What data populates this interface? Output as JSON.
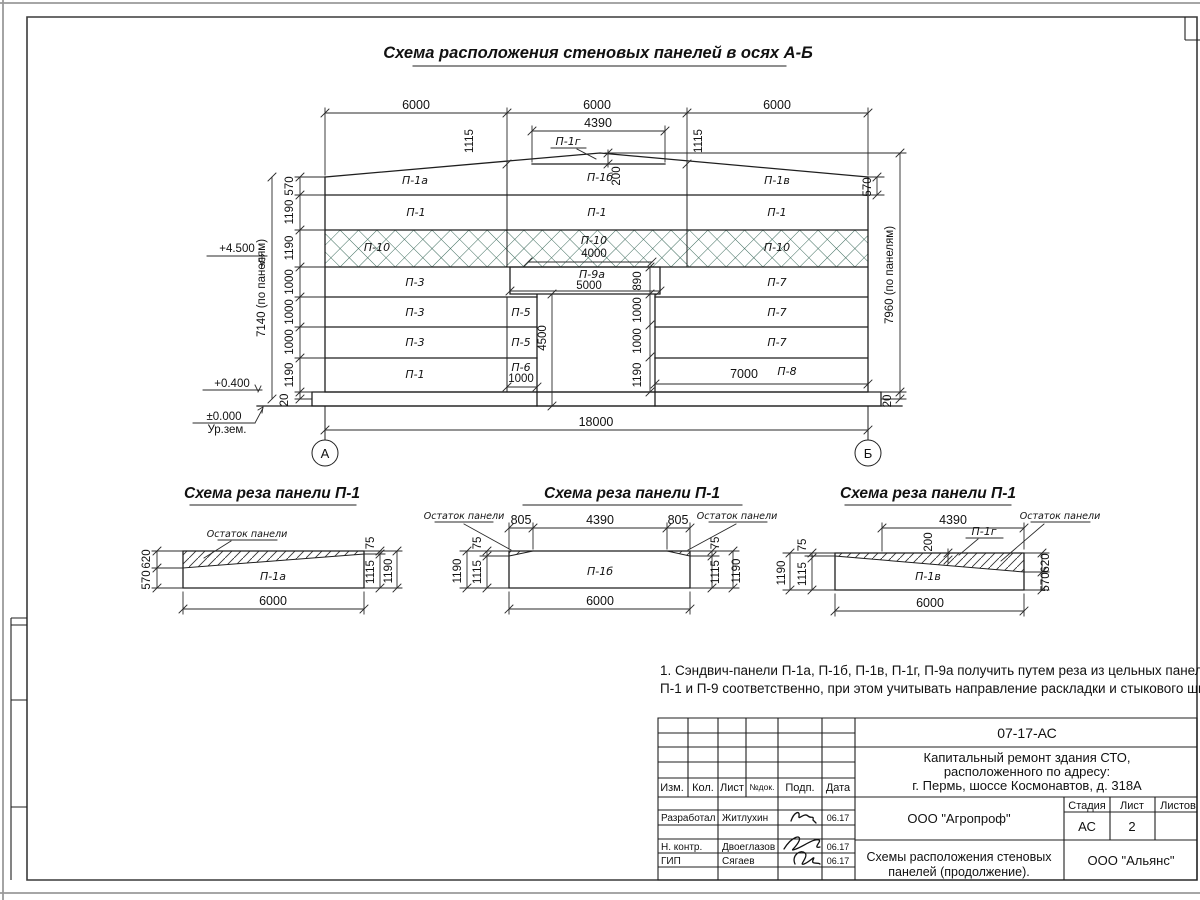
{
  "drawing_title": "Схема расположения стеновых панелей в осях А-Б",
  "elevation": {
    "bay_dims": [
      "6000",
      "6000",
      "6000"
    ],
    "dim_4390": "4390",
    "dim_1115_left": "1115",
    "dim_1115_right": "1115",
    "dim_200": "200",
    "left_chain": [
      "570",
      "1190",
      "1190",
      "1000",
      "1000",
      "1000",
      "1190",
      "20"
    ],
    "left_total": "7140 (по панелям)",
    "right_570": "570",
    "right_total": "7960 (по панелям)",
    "right_20": "20",
    "door_chain": [
      "890",
      "1000",
      "1000",
      "1190"
    ],
    "door_height": "4500",
    "dim_4000": "4000",
    "dim_5000": "5000",
    "dim_1000": "1000",
    "dim_7000": "7000",
    "dim_18000": "18000",
    "level_top": "+4.500",
    "level_mid": "+0.400",
    "level_zero": "±0.000",
    "ground_label": "Ур.зем.",
    "axis_left": "А",
    "axis_right": "Б",
    "panels": {
      "p1a": "П-1а",
      "p1b": "П-1б",
      "p1v": "П-1в",
      "p1g": "П-1г",
      "p1": "П-1",
      "p10": "П-10",
      "p3": "П-3",
      "p9a": "П-9а",
      "p7": "П-7",
      "p5": "П-5",
      "p6": "П-6",
      "p8": "П-8"
    }
  },
  "schemes": {
    "title": "Схема реза панели П-1",
    "remnant": "Остаток панели",
    "s1": {
      "panel": "П-1а",
      "d620": "620",
      "d570": "570",
      "d75": "75",
      "d1115": "1115",
      "d1190": "1190",
      "d6000": "6000"
    },
    "s2": {
      "panel": "П-1б",
      "d805": "805",
      "d4390": "4390",
      "d75": "75",
      "d1115": "1115",
      "d1190": "1190",
      "d6000": "6000"
    },
    "s3": {
      "panel": "П-1в",
      "wedge": "П-1г",
      "d4390": "4390",
      "d200": "200",
      "d75": "75",
      "d1115": "1115",
      "d1190": "1190",
      "d620": "620",
      "d570": "570",
      "d6000": "6000"
    }
  },
  "note": {
    "line1": "1. Сэндвич-панели П-1а, П-1б, П-1в, П-1г, П-9а получить путем реза из цельных панелей",
    "line2": "П-1 и П-9 соответственно, при этом учитывать направление раскладки и стыкового шва."
  },
  "titleblock": {
    "doc_number": "07-17-АС",
    "project_line1": "Капитальный ремонт здания СТО,",
    "project_line2": "расположенного по адресу:",
    "project_line3": "г. Пермь, шоссе Космонавтов, д. 318А",
    "header": {
      "izm": "Изм.",
      "kol": "Кол.",
      "list": "Лист",
      "ndok": "№док.",
      "podp": "Подп.",
      "data": "Дата"
    },
    "stage_label": "Стадия",
    "sheet_label": "Лист",
    "sheets_label": "Листов",
    "stage": "АС",
    "sheet_number": "2",
    "company": "ООО \"Агропроф\"",
    "sheet_title_line1": "Схемы расположения стеновых",
    "sheet_title_line2": "панелей (продолжение).",
    "contractor": "ООО \"Альянс\"",
    "rows": [
      {
        "role": "Разработал",
        "name": "Житлухин",
        "date": "06.17"
      },
      {
        "role": "Н. контр.",
        "name": "Двоеглазов",
        "date": "06.17"
      },
      {
        "role": "ГИП",
        "name": "Сягаев",
        "date": "06.17"
      }
    ]
  }
}
